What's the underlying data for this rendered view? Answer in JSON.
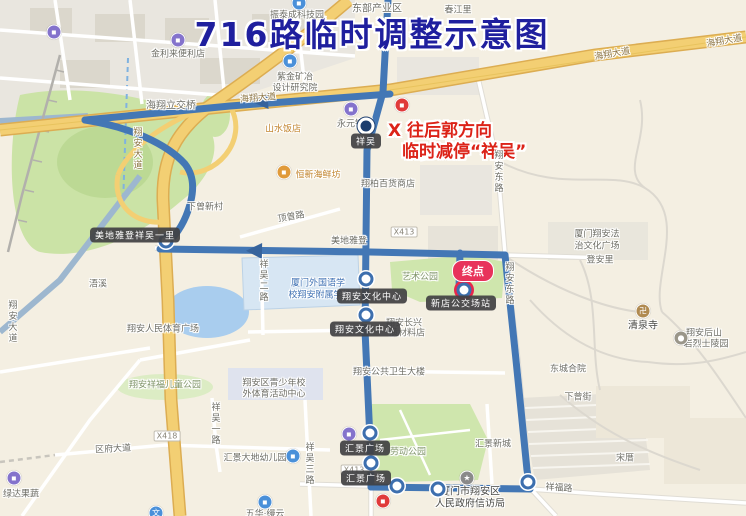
{
  "title": {
    "text": "716路临时调整示意图",
    "color": "#1f1f9e"
  },
  "annotation": {
    "line1": "X 往后郭方向",
    "line2": "临时减停“祥吴”",
    "color": "#dc2318"
  },
  "terminus_badge": "终点",
  "colors": {
    "route": "#4377b5",
    "road_major": "#f3cf73",
    "park": "#cfe6ad",
    "water": "#a9cdee",
    "background": "#f4efe2"
  },
  "map_labels": [
    {
      "text": "东部产业区",
      "x": 377,
      "y": 7,
      "t": "lbl gray10"
    },
    {
      "text": "春江里",
      "x": 458,
      "y": 9,
      "t": "lbl"
    },
    {
      "text": "振泰成科技园",
      "x": 297,
      "y": 14,
      "t": "lbl"
    },
    {
      "text": "金利来便利店",
      "x": 178,
      "y": 53,
      "t": "lbl"
    },
    {
      "text": "海翔大道",
      "x": 612,
      "y": 53,
      "t": "lbl gold",
      "r": -10
    },
    {
      "text": "海翔大道",
      "x": 724,
      "y": 40,
      "t": "lbl gold",
      "r": -10
    },
    {
      "text": "海翔大道",
      "x": 258,
      "y": 97,
      "t": "lbl gold",
      "r": -5
    },
    {
      "text": "紫金矿冶",
      "x": 295,
      "y": 76,
      "t": "lbl"
    },
    {
      "text": "设计研究院",
      "x": 295,
      "y": 87,
      "t": "lbl"
    },
    {
      "text": "海翔立交桥",
      "x": 171,
      "y": 104,
      "t": "lbl gray10"
    },
    {
      "text": "翔安大道",
      "x": 137,
      "y": 149,
      "t": "lbl gold v"
    },
    {
      "text": "山水饭店",
      "x": 283,
      "y": 128,
      "t": "lbl orange"
    },
    {
      "text": "永元钢材",
      "x": 355,
      "y": 123,
      "t": "lbl"
    },
    {
      "text": "恒新海鲜坊",
      "x": 318,
      "y": 174,
      "t": "lbl orange"
    },
    {
      "text": "翔柏百货商店",
      "x": 388,
      "y": 183,
      "t": "lbl"
    },
    {
      "text": "下曾新村",
      "x": 205,
      "y": 206,
      "t": "lbl"
    },
    {
      "text": "顶曾路",
      "x": 291,
      "y": 216,
      "t": "lbl",
      "r": -10
    },
    {
      "text": "美地雅登",
      "x": 349,
      "y": 240,
      "t": "lbl"
    },
    {
      "text": "X413",
      "x": 404,
      "y": 232,
      "t": "lbl shield"
    },
    {
      "text": "厦门翔安法",
      "x": 597,
      "y": 233,
      "t": "lbl"
    },
    {
      "text": "治文化广场",
      "x": 597,
      "y": 245,
      "t": "lbl"
    },
    {
      "text": "登安里",
      "x": 600,
      "y": 259,
      "t": "lbl"
    },
    {
      "text": "翔安东路",
      "x": 498,
      "y": 172,
      "t": "lbl v"
    },
    {
      "text": "翔安东路",
      "x": 509,
      "y": 284,
      "t": "lbl v"
    },
    {
      "text": "祥吴二路",
      "x": 263,
      "y": 281,
      "t": "lbl v"
    },
    {
      "text": "厦门外国语学",
      "x": 318,
      "y": 282,
      "t": "lbl blue"
    },
    {
      "text": "校翔安附属学校",
      "x": 320,
      "y": 294,
      "t": "lbl blue"
    },
    {
      "text": "艺术公园",
      "x": 420,
      "y": 276,
      "t": "lbl green"
    },
    {
      "text": "翔安长兴",
      "x": 404,
      "y": 322,
      "t": "lbl"
    },
    {
      "text": "潢材料店",
      "x": 407,
      "y": 332,
      "t": "lbl"
    },
    {
      "text": "清泉寺",
      "x": 643,
      "y": 324,
      "t": "lbl dark"
    },
    {
      "text": "翔安后山",
      "x": 704,
      "y": 332,
      "t": "lbl"
    },
    {
      "text": "岩烈士陵园",
      "x": 706,
      "y": 343,
      "t": "lbl"
    },
    {
      "text": "浯溪",
      "x": 98,
      "y": 283,
      "t": "lbl"
    },
    {
      "text": "翔安大道",
      "x": 12,
      "y": 322,
      "t": "lbl v"
    },
    {
      "text": "翔安人民体育广场",
      "x": 163,
      "y": 328,
      "t": "lbl"
    },
    {
      "text": "翔安公共卫生大楼",
      "x": 389,
      "y": 371,
      "t": "lbl"
    },
    {
      "text": "东城合院",
      "x": 568,
      "y": 368,
      "t": "lbl"
    },
    {
      "text": "下曾街",
      "x": 578,
      "y": 396,
      "t": "lbl"
    },
    {
      "text": "翔安区青少年校",
      "x": 274,
      "y": 382,
      "t": "lbl"
    },
    {
      "text": "外体育活动中心",
      "x": 274,
      "y": 393,
      "t": "lbl"
    },
    {
      "text": "翔安祥福儿童公园",
      "x": 165,
      "y": 384,
      "t": "lbl green"
    },
    {
      "text": "X418",
      "x": 167,
      "y": 436,
      "t": "lbl shield"
    },
    {
      "text": "X413",
      "x": 354,
      "y": 470,
      "t": "lbl shield"
    },
    {
      "text": "区府大道",
      "x": 113,
      "y": 448,
      "t": "lbl",
      "r": -3
    },
    {
      "text": "祥吴一路",
      "x": 215,
      "y": 424,
      "t": "lbl v"
    },
    {
      "text": "祥吴三路",
      "x": 309,
      "y": 464,
      "t": "lbl v"
    },
    {
      "text": "汇景大地幼儿园",
      "x": 255,
      "y": 457,
      "t": "lbl"
    },
    {
      "text": "劳动公园",
      "x": 408,
      "y": 451,
      "t": "lbl green"
    },
    {
      "text": "汇景新城",
      "x": 493,
      "y": 443,
      "t": "lbl"
    },
    {
      "text": "厦门市翔安区",
      "x": 470,
      "y": 490,
      "t": "lbl dark"
    },
    {
      "text": "人民政府信访局",
      "x": 470,
      "y": 502,
      "t": "lbl dark"
    },
    {
      "text": "祥福路",
      "x": 559,
      "y": 487,
      "t": "lbl",
      "r": 4
    },
    {
      "text": "宋厝",
      "x": 625,
      "y": 457,
      "t": "lbl"
    },
    {
      "text": "五华·缦云",
      "x": 265,
      "y": 513,
      "t": "lbl"
    },
    {
      "text": "绿达果蔬",
      "x": 21,
      "y": 493,
      "t": "lbl"
    },
    {
      "text": "祥吴",
      "x": 366,
      "y": 141,
      "t": "lbl stoplabel"
    },
    {
      "text": "美地雅登祥吴一里",
      "x": 135,
      "y": 235,
      "t": "lbl stoplabel"
    },
    {
      "text": "翔安文化中心",
      "x": 372,
      "y": 296,
      "t": "lbl stoplabel"
    },
    {
      "text": "翔安文化中心",
      "x": 365,
      "y": 329,
      "t": "lbl stoplabel"
    },
    {
      "text": "新店公交场站",
      "x": 461,
      "y": 303,
      "t": "lbl stoplabel"
    },
    {
      "text": "汇景广场",
      "x": 365,
      "y": 448,
      "t": "lbl stoplabel"
    },
    {
      "text": "汇景广场",
      "x": 366,
      "y": 478,
      "t": "lbl stoplabel"
    }
  ],
  "bus_stops": [
    {
      "x": 366,
      "y": 126,
      "v": "major",
      "name": "stop-xiangwu"
    },
    {
      "x": 166,
      "y": 241,
      "v": "",
      "name": "stop-meidiyadeng"
    },
    {
      "x": 366,
      "y": 279,
      "v": "",
      "name": "stop-wenhuazhongxin-1"
    },
    {
      "x": 366,
      "y": 315,
      "v": "",
      "name": "stop-wenhuazhongxin-2"
    },
    {
      "x": 370,
      "y": 433,
      "v": "",
      "name": "stop-huijing-1"
    },
    {
      "x": 371,
      "y": 463,
      "v": "",
      "name": "stop-huijing-2"
    },
    {
      "x": 397,
      "y": 486,
      "v": "",
      "name": "stop-south-1"
    },
    {
      "x": 438,
      "y": 489,
      "v": "",
      "name": "stop-south-2"
    },
    {
      "x": 528,
      "y": 482,
      "v": "",
      "name": "stop-corner"
    },
    {
      "x": 464,
      "y": 290,
      "v": "terminus",
      "name": "stop-xindian-terminus"
    }
  ],
  "poi_icons": [
    {
      "x": 54,
      "y": 32,
      "c": "#8473cc",
      "g": "▪",
      "name": "shop-icon"
    },
    {
      "x": 178,
      "y": 40,
      "c": "#8473cc",
      "g": "▪",
      "name": "convenience-store-icon"
    },
    {
      "x": 299,
      "y": 3,
      "c": "#4a90d9",
      "g": "▪",
      "name": "tech-park-icon"
    },
    {
      "x": 290,
      "y": 61,
      "c": "#4a90d9",
      "g": "▪",
      "name": "institute-icon"
    },
    {
      "x": 402,
      "y": 105,
      "c": "#e03a3a",
      "g": "▪",
      "name": "mall-icon"
    },
    {
      "x": 351,
      "y": 109,
      "c": "#8473cc",
      "g": "▪",
      "name": "steel-shop-icon"
    },
    {
      "x": 284,
      "y": 172,
      "c": "#e09a3a",
      "g": "▪",
      "name": "restaurant-icon"
    },
    {
      "x": 643,
      "y": 311,
      "c": "#b08a50",
      "g": "卍",
      "name": "temple-icon"
    },
    {
      "x": 681,
      "y": 338,
      "c": "#9a968a",
      "g": "●",
      "name": "memorial-icon"
    },
    {
      "x": 349,
      "y": 434,
      "c": "#8473cc",
      "g": "▪",
      "name": "plaza-mall-icon"
    },
    {
      "x": 467,
      "y": 478,
      "c": "#8a8a8a",
      "g": "★",
      "name": "government-icon"
    },
    {
      "x": 383,
      "y": 501,
      "c": "#e03a3a",
      "g": "▪",
      "name": "shop-icon"
    },
    {
      "x": 293,
      "y": 456,
      "c": "#4a90d9",
      "g": "▪",
      "name": "kindergarten-icon"
    },
    {
      "x": 265,
      "y": 502,
      "c": "#4a90d9",
      "g": "▪",
      "name": "residence-icon"
    },
    {
      "x": 156,
      "y": 513,
      "c": "#4a90d9",
      "g": "文",
      "name": "culture-icon"
    },
    {
      "x": 14,
      "y": 478,
      "c": "#8473cc",
      "g": "▪",
      "name": "grocery-icon"
    }
  ]
}
